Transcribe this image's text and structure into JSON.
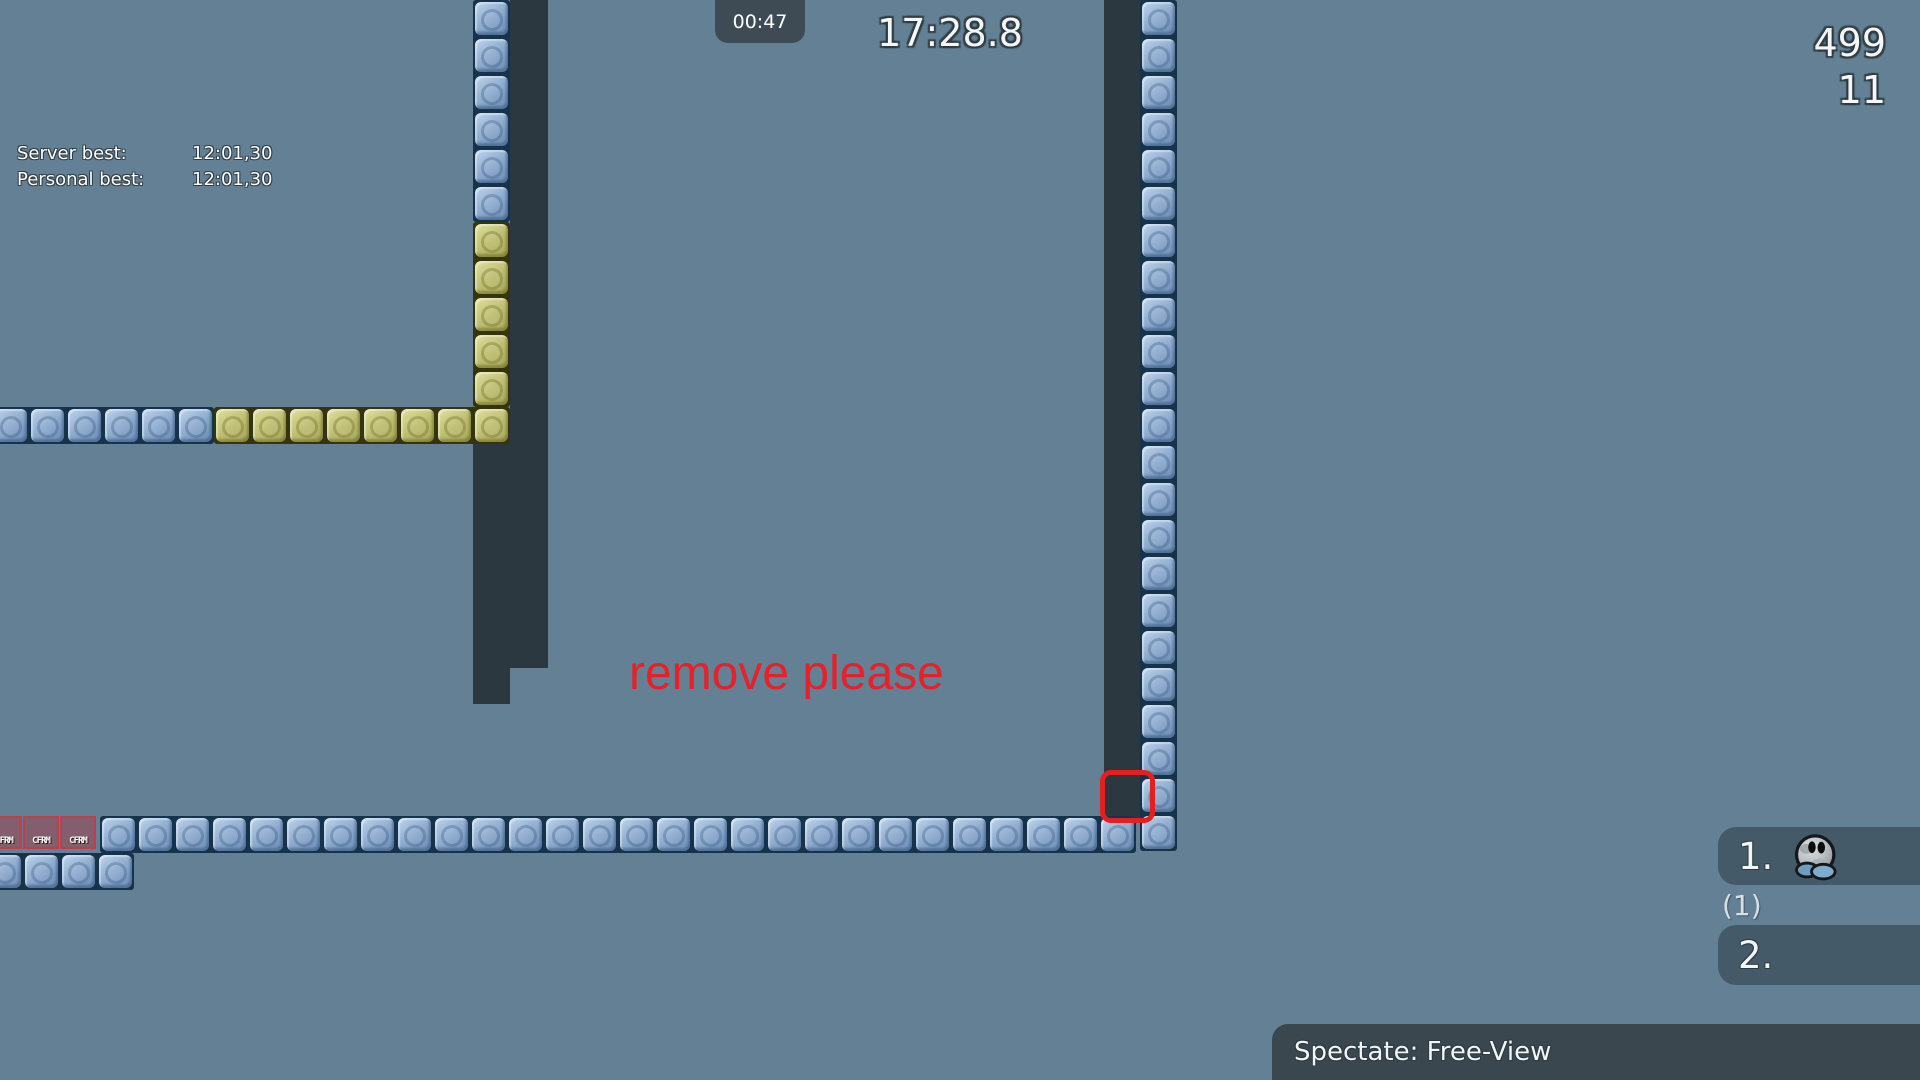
{
  "colors": {
    "background": "#648094",
    "wall": "#2c3840",
    "tile_blue": "#7e9dc2",
    "tile_blue_outline": "#16334e",
    "tile_yellow": "#bcbc70",
    "tile_yellow_outline": "#34340e",
    "freeze_tile": "#984856",
    "annotation_red": "#e62129",
    "marker_red": "#e32020",
    "hud_panel": "#3e4b54",
    "scoreboard_row": "rgba(40,55,65,0.52)"
  },
  "hud": {
    "server_best_label": "Server best:",
    "server_best_value": "12:01,30",
    "personal_best_label": "Personal best:",
    "personal_best_value": "12:01,30",
    "checkpoint_time": "00:47",
    "race_time": "17:28.8",
    "fps": "499",
    "ping": "11"
  },
  "annotation": {
    "text": "remove please"
  },
  "map": {
    "tile_label_cfrm": "CFRM",
    "tile_pitch": 37,
    "runs": [
      {
        "type": "blue",
        "dir": "v",
        "x": 475,
        "y": 2,
        "count": 6
      },
      {
        "type": "yellow",
        "dir": "v",
        "x": 475,
        "y": 224,
        "count": 5
      },
      {
        "type": "blue",
        "dir": "h",
        "x": -6,
        "y": 409,
        "count": 6
      },
      {
        "type": "yellow",
        "dir": "h",
        "x": 216,
        "y": 409,
        "count": 8
      },
      {
        "type": "blue",
        "dir": "v",
        "x": 1142,
        "y": 2,
        "count": 23
      },
      {
        "type": "blue",
        "dir": "h",
        "x": 102,
        "y": 818,
        "count": 28
      },
      {
        "type": "cfrm",
        "dir": "h",
        "x": -12,
        "y": 818,
        "count": 3
      },
      {
        "type": "blue",
        "dir": "h",
        "x": -12,
        "y": 855,
        "count": 4
      }
    ],
    "walls": [
      {
        "x": 510,
        "y": 0,
        "w": 38,
        "h": 668
      },
      {
        "x": 473,
        "y": 442,
        "w": 37,
        "h": 262
      },
      {
        "x": 1104,
        "y": 0,
        "w": 38,
        "h": 818
      }
    ],
    "marker_box": {
      "x": 1100,
      "y": 770,
      "w": 55,
      "h": 53
    }
  },
  "scoreboard": {
    "rows": [
      {
        "rank": "1.",
        "has_avatar": true
      },
      {
        "rank": "2.",
        "has_avatar": false
      }
    ],
    "spectator_count": "(1)"
  },
  "spectate_bar": {
    "label": "Spectate: Free-View"
  }
}
